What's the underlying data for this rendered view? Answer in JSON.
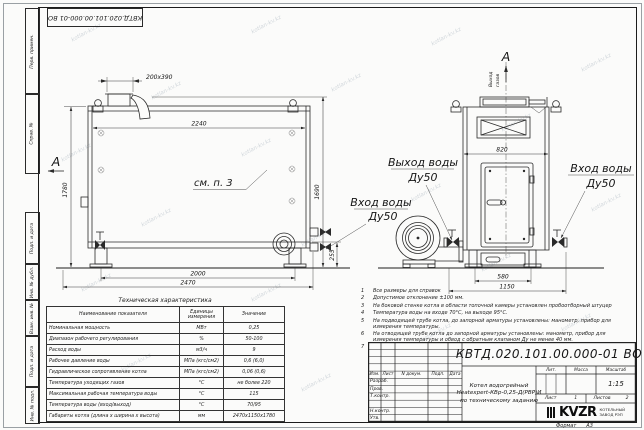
{
  "frame": {
    "doc_number_top": "КВТД.020.101.00.000-01 ВО",
    "left_labels": [
      "Перв. примен.",
      "Справ. №",
      "Подп. и дата",
      "Инв. № дубл.",
      "Взам. инв. №",
      "Подп. и дата",
      "Инв. № подл."
    ],
    "format_label": "Формат",
    "format_value": "А3"
  },
  "drawing": {
    "watermark": "kotlan-kv.kz",
    "section_mark_front": "А",
    "section_mark_side": "А",
    "see_note_ref": "см. п. 3",
    "gas_outlet_line1": "Выход",
    "gas_outlet_line2": "газов",
    "label_water_outlet_1": "Выход воды",
    "label_water_outlet_2": "Ду50",
    "label_water_inlet_side_1": "Вход воды",
    "label_water_inlet_side_2": "Ду50",
    "label_water_inlet_front_1": "Вход воды",
    "label_water_inlet_front_2": "Ду50",
    "dim_chimney": "200х390",
    "dim_top_width": "2240",
    "dim_height_total": "1780",
    "dim_height_flue": "1690",
    "dim_base_height": "255",
    "dim_leg_span": "2000",
    "dim_length_total": "2470",
    "dim_side_width_top": "820",
    "dim_side_base": "580",
    "dim_side_width_total": "1150"
  },
  "tech_table": {
    "title": "Техническая характеристика",
    "headers": {
      "name": "Наименование показателя",
      "unit": "Единицы измерения",
      "value": "Значение"
    },
    "rows": [
      {
        "name": "Номинальная мощность",
        "unit": "МВт",
        "value": "0,25"
      },
      {
        "name": "Диапазон рабочего регулирования",
        "unit": "%",
        "value": "50-100"
      },
      {
        "name": "Расход воды",
        "unit": "м3/ч",
        "value": "9"
      },
      {
        "name": "Рабочее давление воды",
        "unit": "МПа (кгс/см2)",
        "value": "0,6 (6,0)"
      },
      {
        "name": "Гидравлическое сопротивление котла",
        "unit": "МПа (кгс/см2)",
        "value": "0,06 (0,6)"
      },
      {
        "name": "Температура уходящих газов",
        "unit": "°С",
        "value": "не более 220"
      },
      {
        "name": "Максимальная рабочая температура воды",
        "unit": "°С",
        "value": "115"
      },
      {
        "name": "Температура воды (вход/выход)",
        "unit": "°С",
        "value": "70/95"
      },
      {
        "name": "Габариты котла (длина х ширина х высота)",
        "unit": "мм",
        "value": "2470х1150х1780"
      }
    ]
  },
  "notes": {
    "items": [
      {
        "num": "1",
        "text": "Все размеры для справок"
      },
      {
        "num": "2",
        "text": "Допустимое отклонение ±100 мм."
      },
      {
        "num": "3",
        "text": "На боковой стенке котла в области топочной камеры установлен пробоотборный штуцер"
      },
      {
        "num": "4",
        "text": "Температура воды на входе 70°С, на выходе 95°С."
      },
      {
        "num": "5",
        "text": "На подводящей трубе котла, до запорной арматуры установлены: манометр, прибор для измерения температуры."
      },
      {
        "num": "6",
        "text": "На отводящей трубе котла до запорной арматуры установлены: манометр, прибор для измерения температуры и обвод с обратным клапаном Ду не менее 40 мм."
      },
      {
        "num": "7",
        "text": "Остальные технические требования по ОСТ 108.030.133-84."
      }
    ]
  },
  "title_block": {
    "doc_number": "КВТД.020.101.00.000-01 ВО",
    "name_line1": "Котел водогрейный",
    "name_line2": "Heatexpert-КВр-0,25-Д(РВР)И",
    "name_line3": "по техническому заданию",
    "col_izm": "Изм.",
    "col_list": "Лист",
    "col_dokum": "N докум.",
    "col_podp": "Подп.",
    "col_data": "Дата",
    "rows": [
      "Разраб.",
      "Пров.",
      "Т.контр.",
      "",
      "Н.контр.",
      "Утв."
    ],
    "lit_label": "Лит.",
    "massa_label": "Масса",
    "masshtab_label": "Масштаб",
    "scale_value": "1:15",
    "list_label": "Лист",
    "list_value": "1",
    "listov_label": "Листов",
    "listov_value": "2",
    "logo_text": "KVZR",
    "org_line1": "КОТЕЛЬНЫЙ",
    "org_line2": "ЗАВОД РЭП"
  }
}
